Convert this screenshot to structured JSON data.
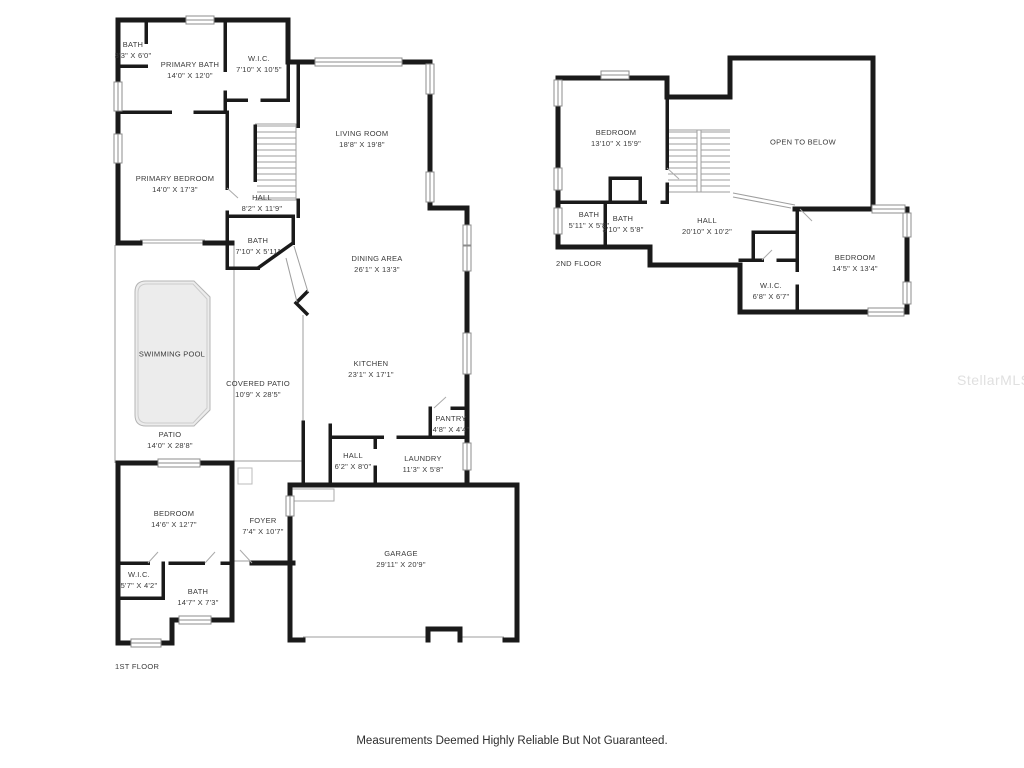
{
  "floor1": {
    "caption": "1ST FLOOR",
    "rooms": [
      {
        "name": "BATH",
        "dims": "3'3\" X 6'0\""
      },
      {
        "name": "PRIMARY BATH",
        "dims": "14'0\" X 12'0\""
      },
      {
        "name": "W.I.C.",
        "dims": "7'10\" X 10'5\""
      },
      {
        "name": "LIVING ROOM",
        "dims": "18'8\" X 19'8\""
      },
      {
        "name": "PRIMARY BEDROOM",
        "dims": "14'0\" X 17'3\""
      },
      {
        "name": "HALL",
        "dims": "8'2\" X 11'9\""
      },
      {
        "name": "BATH",
        "dims": "7'10\" X 5'11\""
      },
      {
        "name": "DINING AREA",
        "dims": "26'1\" X 13'3\""
      },
      {
        "name": "KITCHEN",
        "dims": "23'1\" X 17'1\""
      },
      {
        "name": "SWIMMING POOL"
      },
      {
        "name": "COVERED PATIO",
        "dims": "10'9\" X 28'5\""
      },
      {
        "name": "PATIO",
        "dims": "14'0\" X 28'8\""
      },
      {
        "name": "PANTRY",
        "dims": "4'8\" X 4'4\""
      },
      {
        "name": "HALL",
        "dims": "6'2\" X 8'0\""
      },
      {
        "name": "LAUNDRY",
        "dims": "11'3\" X 5'8\""
      },
      {
        "name": "BEDROOM",
        "dims": "14'6\" X 12'7\""
      },
      {
        "name": "FOYER",
        "dims": "7'4\" X 10'7\""
      },
      {
        "name": "W.I.C.",
        "dims": "5'7\" X 4'2\""
      },
      {
        "name": "BATH",
        "dims": "14'7\" X 7'3\""
      },
      {
        "name": "GARAGE",
        "dims": "29'11\" X 20'9\""
      }
    ]
  },
  "floor2": {
    "caption": "2ND FLOOR",
    "rooms": [
      {
        "name": "BEDROOM",
        "dims": "13'10\" X 15'9\""
      },
      {
        "name": "OPEN TO BELOW"
      },
      {
        "name": "BATH",
        "dims": "5'11\" X 5'8\""
      },
      {
        "name": "BATH",
        "dims": "3'10\" X 5'8\""
      },
      {
        "name": "HALL",
        "dims": "20'10\" X 10'2\""
      },
      {
        "name": "BEDROOM",
        "dims": "14'5\" X 13'4\""
      },
      {
        "name": "W.I.C.",
        "dims": "6'8\" X 6'7\""
      }
    ]
  },
  "footer": "Measurements Deemed Highly Reliable But Not Guaranteed.",
  "watermark": "StellarMLS",
  "colors": {
    "wall": "#1a1a1a",
    "label_text": "#3a3a3a",
    "pool_fill": "#ececec",
    "window_frame": "#8c8c8c",
    "watermark": "#e0e0e0"
  }
}
